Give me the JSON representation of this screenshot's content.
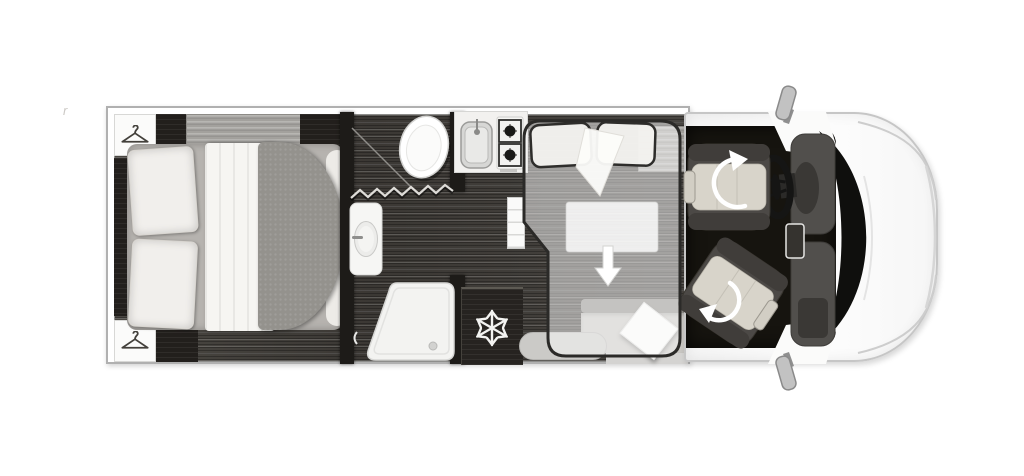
{
  "meta": {
    "type": "motorhome-floorplan-top-view",
    "visible_text": "none"
  },
  "watermark": {
    "glyph": "r"
  },
  "colors": {
    "background": "#ffffff",
    "wood_floor": "#44413d",
    "dark_cabinet": "#221f1c",
    "wall_line": "#b0b0b0",
    "cab_floor": "#16140f",
    "hood_white": "#f8f8f8",
    "seat_cushion": "#d8d4ca",
    "seat_frame": "#4c4946",
    "overlay_border": "#2b2a28",
    "blanket_gray": "#94928d",
    "snowflake_white": "#f3f3f1"
  },
  "icons": {
    "hanger": "clothes-hanger-icon",
    "snowflake": "snowflake-icon",
    "rotate_driver": "rotation-arrow-icon",
    "rotate_passenger": "rotation-arrow-icon",
    "drop_bed_arrow": "drop-down-arrow-icon"
  },
  "areas": {
    "rear": "island-bed-bedroom",
    "middle": "bathroom-shower-kitchen",
    "front_living": "lounge-with-drop-down-bed",
    "cab": "driver-cab-swivel-seats"
  }
}
